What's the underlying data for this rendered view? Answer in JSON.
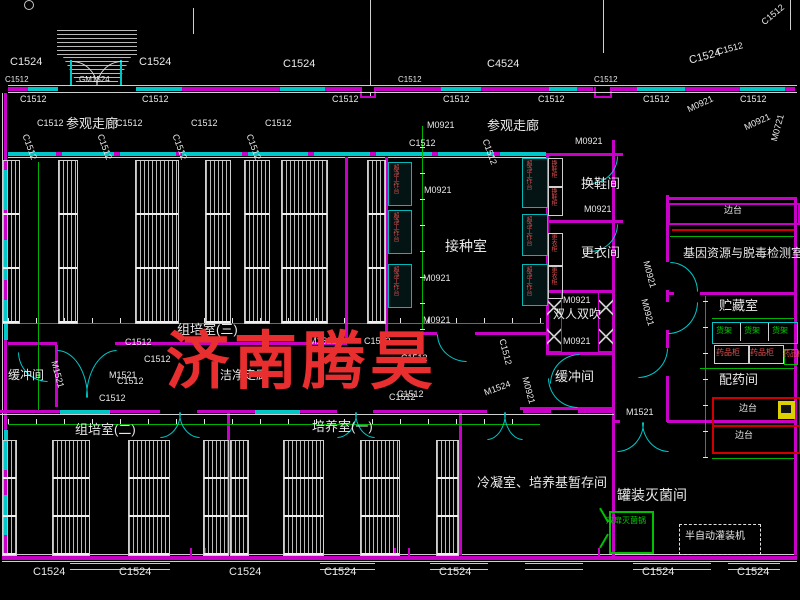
{
  "watermark": {
    "text": "济南腾昊",
    "color": "#e82e2e"
  },
  "colors": {
    "background": "#000000",
    "wall_magenta": "#c800c8",
    "window_cyan": "#00c8c8",
    "dimension_green": "#00b300",
    "equipment_red": "#e05050",
    "bench_red": "#d00000",
    "shelf_green": "#00c000",
    "text_white": "#e8e8e8",
    "watermark_red": "#e82e2e"
  },
  "labels": {
    "rooms": [
      {
        "t": "参观走廊",
        "x": 66,
        "y": 117,
        "s": 13
      },
      {
        "t": "参观走廊",
        "x": 487,
        "y": 119,
        "s": 13
      },
      {
        "t": "接种室",
        "x": 445,
        "y": 239,
        "s": 14
      },
      {
        "t": "换鞋间",
        "x": 581,
        "y": 177,
        "s": 13
      },
      {
        "t": "更衣间",
        "x": 581,
        "y": 246,
        "s": 13
      },
      {
        "t": "双人双吹",
        "x": 553,
        "y": 308,
        "s": 12
      },
      {
        "t": "缓冲间",
        "x": 8,
        "y": 369,
        "s": 12
      },
      {
        "t": "缓冲间",
        "x": 555,
        "y": 370,
        "s": 13
      },
      {
        "t": "组培室(三)",
        "x": 177,
        "y": 323,
        "s": 13
      },
      {
        "t": "洁净走廊",
        "x": 220,
        "y": 369,
        "s": 12
      },
      {
        "t": "组培室(二)",
        "x": 75,
        "y": 423,
        "s": 13
      },
      {
        "t": "培养室(一)",
        "x": 312,
        "y": 420,
        "s": 13
      },
      {
        "t": "冷凝室、培养基暂存间",
        "x": 477,
        "y": 476,
        "s": 13
      },
      {
        "t": "罐装灭菌间",
        "x": 617,
        "y": 488,
        "s": 14
      },
      {
        "t": "基因资源与脱毒检测室",
        "x": 683,
        "y": 247,
        "s": 12
      },
      {
        "t": "贮藏室",
        "x": 719,
        "y": 299,
        "s": 13
      },
      {
        "t": "配药间",
        "x": 719,
        "y": 373,
        "s": 13
      }
    ],
    "dims": [
      {
        "t": "C1524",
        "x": 10,
        "y": 57,
        "s": 11
      },
      {
        "t": "C1524",
        "x": 139,
        "y": 57,
        "s": 11
      },
      {
        "t": "C1524",
        "x": 283,
        "y": 59,
        "s": 11
      },
      {
        "t": "C4524",
        "x": 487,
        "y": 59,
        "s": 11
      },
      {
        "t": "C1524",
        "x": 688,
        "y": 56,
        "s": 11,
        "r": -15
      },
      {
        "t": "C1512",
        "x": 716,
        "y": 48,
        "r": -15
      },
      {
        "t": "C1512",
        "x": 760,
        "y": 20,
        "r": -40
      },
      {
        "t": "GM1524",
        "x": 79,
        "y": 76,
        "s": 8
      },
      {
        "t": "C1512",
        "x": 5,
        "y": 76,
        "s": 8
      },
      {
        "t": "C1512",
        "x": 398,
        "y": 76,
        "s": 8
      },
      {
        "t": "C1512",
        "x": 594,
        "y": 76,
        "s": 8
      },
      {
        "t": "C1512",
        "x": 20,
        "y": 95
      },
      {
        "t": "C1512",
        "x": 142,
        "y": 95
      },
      {
        "t": "C1512",
        "x": 332,
        "y": 95
      },
      {
        "t": "C1512",
        "x": 443,
        "y": 95
      },
      {
        "t": "C1512",
        "x": 538,
        "y": 95
      },
      {
        "t": "C1512",
        "x": 643,
        "y": 95
      },
      {
        "t": "C1512",
        "x": 740,
        "y": 95
      },
      {
        "t": "C1512",
        "x": 37,
        "y": 119
      },
      {
        "t": "C1512",
        "x": 116,
        "y": 119
      },
      {
        "t": "C1512",
        "x": 191,
        "y": 119
      },
      {
        "t": "C1512",
        "x": 265,
        "y": 119
      },
      {
        "t": "M0921",
        "x": 427,
        "y": 121
      },
      {
        "t": "M0921",
        "x": 575,
        "y": 137
      },
      {
        "t": "C1512",
        "x": 409,
        "y": 139
      },
      {
        "t": "C1512",
        "x": 489,
        "y": 138,
        "r": 70
      },
      {
        "t": "C1512",
        "x": 29,
        "y": 133,
        "r": 70
      },
      {
        "t": "C1512",
        "x": 104,
        "y": 133,
        "r": 70
      },
      {
        "t": "C1512",
        "x": 179,
        "y": 133,
        "r": 70
      },
      {
        "t": "C1512",
        "x": 253,
        "y": 133,
        "r": 70
      },
      {
        "t": "M0921",
        "x": 686,
        "y": 106,
        "r": -25
      },
      {
        "t": "M0921",
        "x": 743,
        "y": 124,
        "r": -25
      },
      {
        "t": "M0721",
        "x": 770,
        "y": 140,
        "r": -75
      },
      {
        "t": "M0921",
        "x": 424,
        "y": 186
      },
      {
        "t": "M0921",
        "x": 423,
        "y": 274
      },
      {
        "t": "M0921",
        "x": 423,
        "y": 316
      },
      {
        "t": "M0921",
        "x": 584,
        "y": 205
      },
      {
        "t": "M0921",
        "x": 563,
        "y": 296
      },
      {
        "t": "M0921",
        "x": 563,
        "y": 337
      },
      {
        "t": "M0921",
        "x": 529,
        "y": 376,
        "r": 75
      },
      {
        "t": "M1521",
        "x": 309,
        "y": 337
      },
      {
        "t": "C1512",
        "x": 364,
        "y": 337
      },
      {
        "t": "C1512",
        "x": 125,
        "y": 338
      },
      {
        "t": "C1512",
        "x": 144,
        "y": 355
      },
      {
        "t": "C1512",
        "x": 117,
        "y": 377
      },
      {
        "t": "C1512",
        "x": 99,
        "y": 394
      },
      {
        "t": "M1521",
        "x": 109,
        "y": 371
      },
      {
        "t": "M1521",
        "x": 58,
        "y": 360,
        "r": 75
      },
      {
        "t": "C1512",
        "x": 401,
        "y": 354
      },
      {
        "t": "C1512",
        "x": 397,
        "y": 390
      },
      {
        "t": "C1512",
        "x": 506,
        "y": 338,
        "r": 75
      },
      {
        "t": "M0921",
        "x": 650,
        "y": 260,
        "r": 75
      },
      {
        "t": "M0921",
        "x": 648,
        "y": 298,
        "r": 75
      },
      {
        "t": "M1521",
        "x": 626,
        "y": 408
      },
      {
        "t": "M1524",
        "x": 483,
        "y": 389,
        "r": -20
      },
      {
        "t": "C1512",
        "x": 389,
        "y": 393
      },
      {
        "t": "C1524",
        "x": 33,
        "y": 567,
        "s": 11
      },
      {
        "t": "C1524",
        "x": 119,
        "y": 567,
        "s": 11
      },
      {
        "t": "C1524",
        "x": 229,
        "y": 567,
        "s": 11
      },
      {
        "t": "C1524",
        "x": 324,
        "y": 567,
        "s": 11
      },
      {
        "t": "C1524",
        "x": 439,
        "y": 567,
        "s": 11
      },
      {
        "t": "C1524",
        "x": 642,
        "y": 567,
        "s": 11
      },
      {
        "t": "C1524",
        "x": 737,
        "y": 567,
        "s": 11
      }
    ],
    "equip_white": [
      {
        "t": "边台",
        "x": 724,
        "y": 206,
        "s": 9
      },
      {
        "t": "边台",
        "x": 739,
        "y": 404,
        "s": 9
      },
      {
        "t": "边台",
        "x": 735,
        "y": 431,
        "s": 9
      },
      {
        "t": "半自动灌装机",
        "x": 685,
        "y": 532,
        "s": 10
      }
    ],
    "equip_green": [
      {
        "t": "货架",
        "x": 716,
        "y": 327,
        "s": 8
      },
      {
        "t": "货架",
        "x": 744,
        "y": 327,
        "s": 8
      },
      {
        "t": "货架",
        "x": 772,
        "y": 327,
        "s": 8
      },
      {
        "t": "双扉灭菌锅",
        "x": 606,
        "y": 517,
        "s": 8
      }
    ],
    "equip_red": [
      {
        "t": "药品柜",
        "x": 716,
        "y": 349,
        "s": 8
      },
      {
        "t": "药品柜",
        "x": 750,
        "y": 349,
        "s": 8
      },
      {
        "t": "药品柜",
        "x": 783,
        "y": 351,
        "s": 7
      }
    ],
    "equip_red_vertical": [
      {
        "t": "超净工作台",
        "x": 392,
        "y": 164
      },
      {
        "t": "超净工作台",
        "x": 392,
        "y": 212
      },
      {
        "t": "超净工作台",
        "x": 392,
        "y": 266
      },
      {
        "t": "超净工作台",
        "x": 525,
        "y": 160
      },
      {
        "t": "超净工作台",
        "x": 525,
        "y": 216
      },
      {
        "t": "超净工作台",
        "x": 525,
        "y": 266
      },
      {
        "t": "换鞋柜",
        "x": 550,
        "y": 160
      },
      {
        "t": "换鞋柜",
        "x": 550,
        "y": 188
      },
      {
        "t": "更衣柜",
        "x": 550,
        "y": 234
      },
      {
        "t": "更衣柜",
        "x": 550,
        "y": 267
      }
    ]
  }
}
